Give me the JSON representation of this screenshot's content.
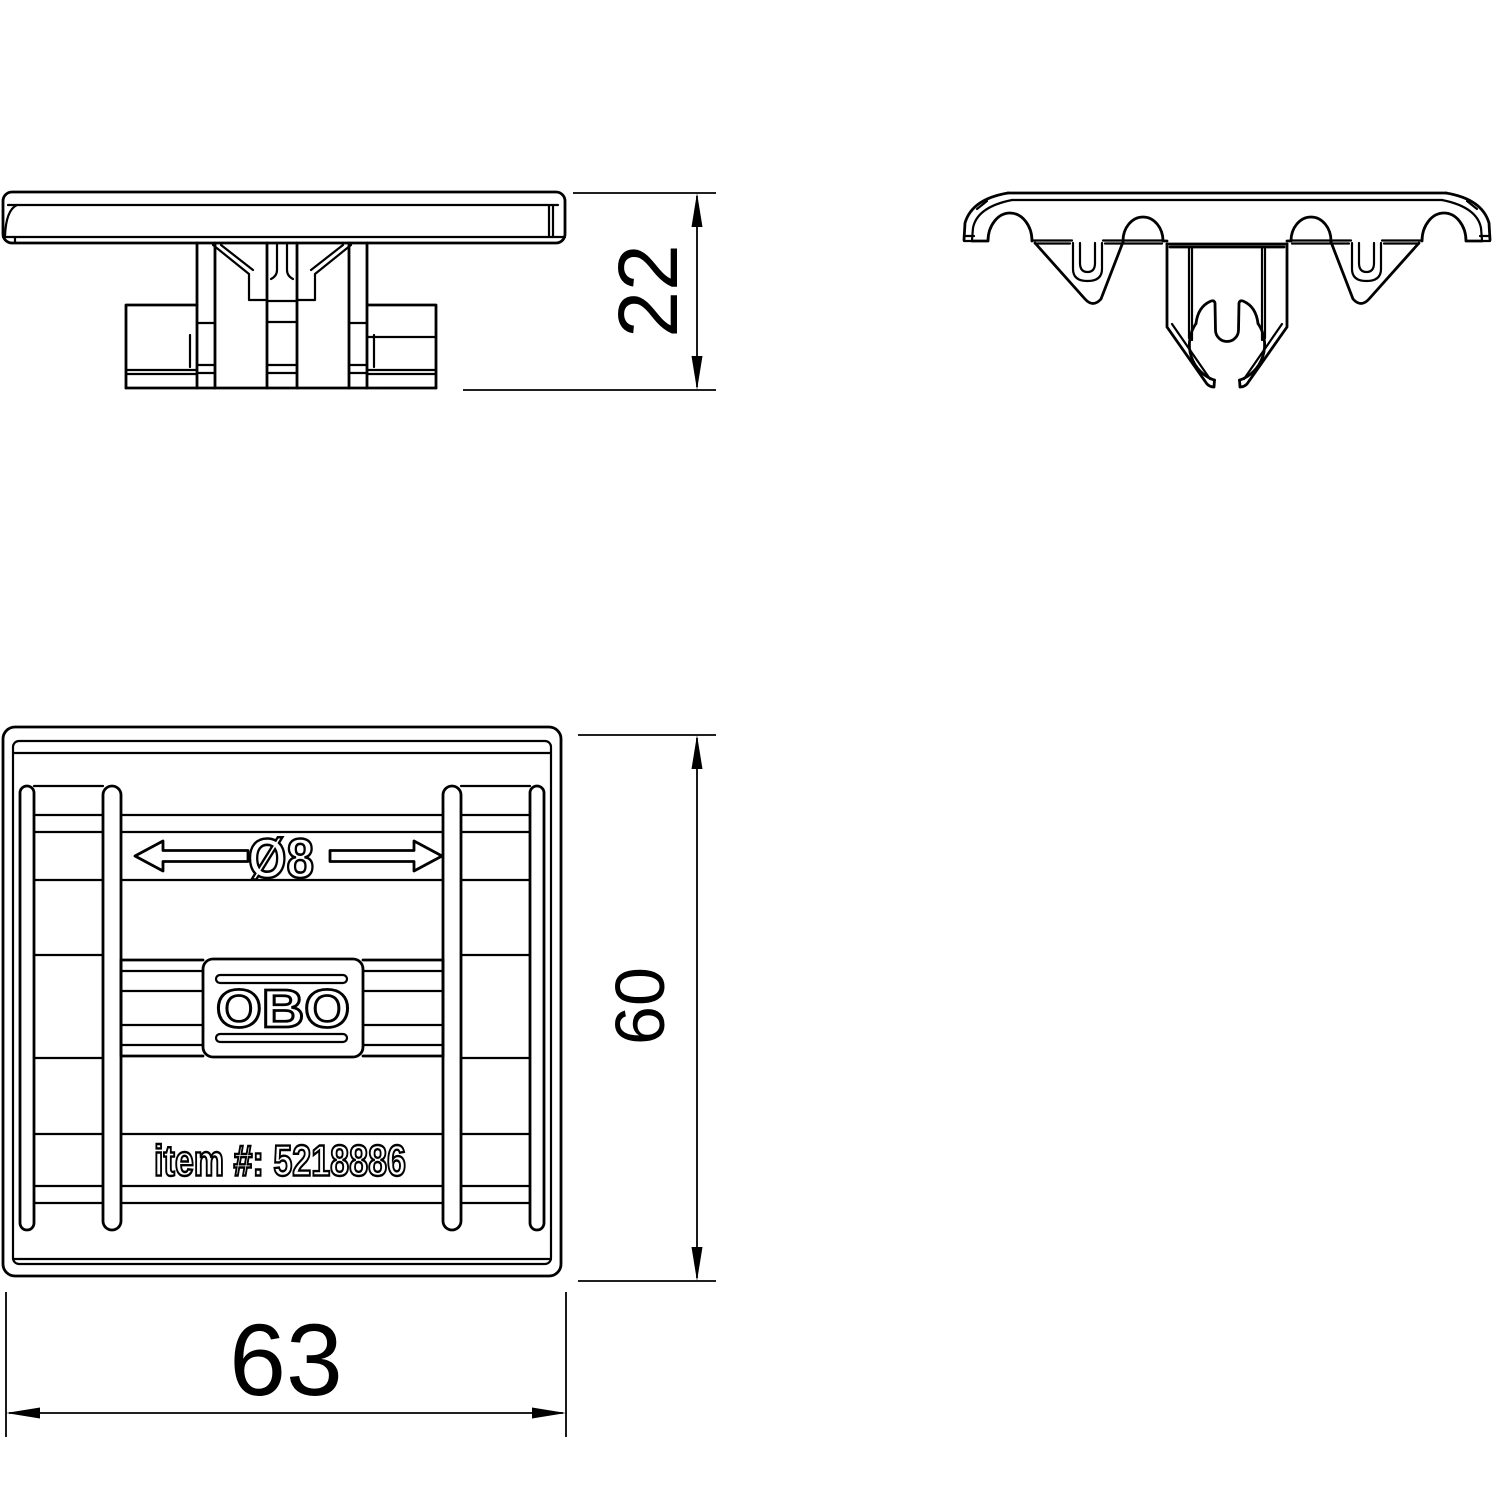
{
  "drawing": {
    "side_view": {
      "height_dimension": "22"
    },
    "front_view": {},
    "plan_view": {
      "diameter_label": "Ø8",
      "logo": "OBO",
      "item_number_label": "item #: 5218886",
      "height_dimension": "60",
      "width_dimension": "63"
    },
    "colors": {
      "line": "#000000",
      "background": "#ffffff"
    }
  }
}
